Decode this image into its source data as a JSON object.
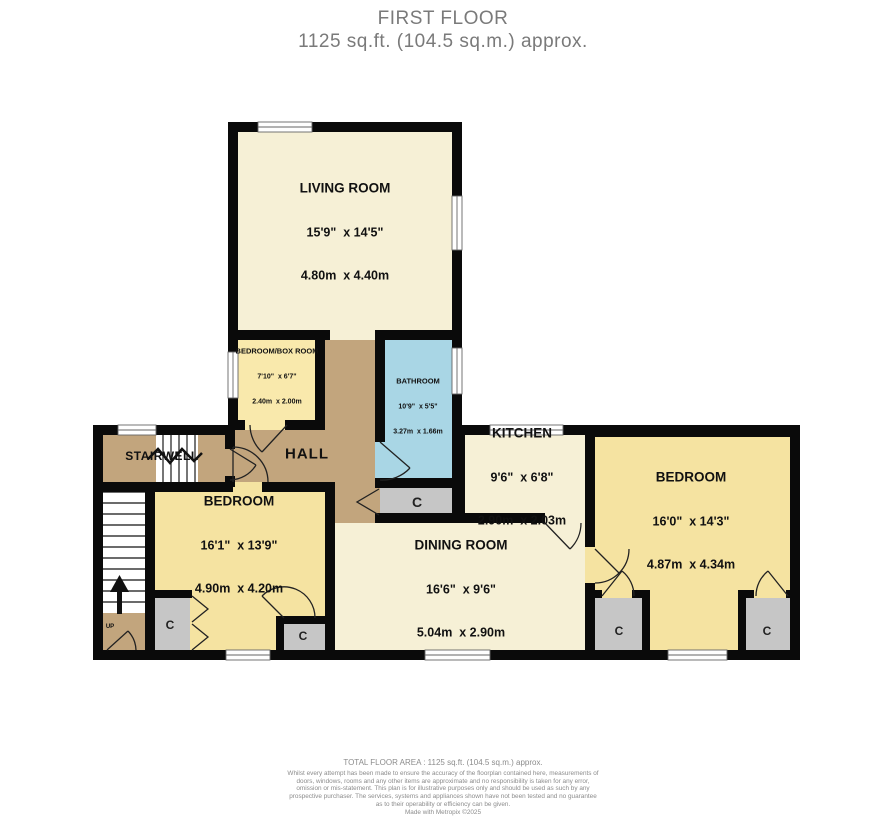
{
  "title": {
    "line1": "FIRST FLOOR",
    "line2": "1125 sq.ft. (104.5 sq.m.) approx."
  },
  "rooms": {
    "living_room": {
      "name": "LIVING ROOM",
      "imperial": "15'9\"  x 14'5\"",
      "metric": "4.80m  x 4.40m"
    },
    "box_room": {
      "name": "BEDROOM/BOX ROOM",
      "imperial": "7'10\"  x 6'7\"",
      "metric": "2.40m  x 2.00m"
    },
    "bathroom": {
      "name": "BATHROOM",
      "imperial": "10'9\"  x 5'5\"",
      "metric": "3.27m  x 1.66m"
    },
    "kitchen": {
      "name": "KITCHEN",
      "imperial": "9'6\"  x 6'8\"",
      "metric": "2.90m  x 2.03m"
    },
    "dining_room": {
      "name": "DINING ROOM",
      "imperial": "16'6\"  x 9'6\"",
      "metric": "5.04m  x 2.90m"
    },
    "bedroom_left": {
      "name": "BEDROOM",
      "imperial": "16'1\"  x 13'9\"",
      "metric": "4.90m  x 4.20m"
    },
    "bedroom_right": {
      "name": "BEDROOM",
      "imperial": "16'0\"  x 14'3\"",
      "metric": "4.87m  x 4.34m"
    }
  },
  "labels": {
    "hall": "HALL",
    "stairwell": "STAIRWELL",
    "up": "UP",
    "closet": "C"
  },
  "footer": {
    "total_area": "TOTAL FLOOR AREA : 1125 sq.ft. (104.5 sq.m.) approx.",
    "disclaimer": "Whilst every attempt has been made to ensure the accuracy of the floorplan contained here, measurements of doors, windows, rooms and any other items are approximate and no responsibility is taken for any error, omission or mis-statement. This plan is for illustrative purposes only and should be used as such by any prospective purchaser. The services, systems and appliances shown have not been tested and no guarantee as to their operability or efficiency can be given.",
    "credit": "Made with Metropix ©2025"
  },
  "colors": {
    "wall": "#0a0a0a",
    "room_cream": "#f6f0d6",
    "room_yellow": "#f5e3a1",
    "room_yellow_light": "#f9e9ac",
    "bathroom_blue": "#a9d6e5",
    "hall_tan": "#c2a57d",
    "closet_gray": "#c6c6c6",
    "title_gray": "#7a7a7a",
    "footer_gray": "#8c8c8c"
  }
}
